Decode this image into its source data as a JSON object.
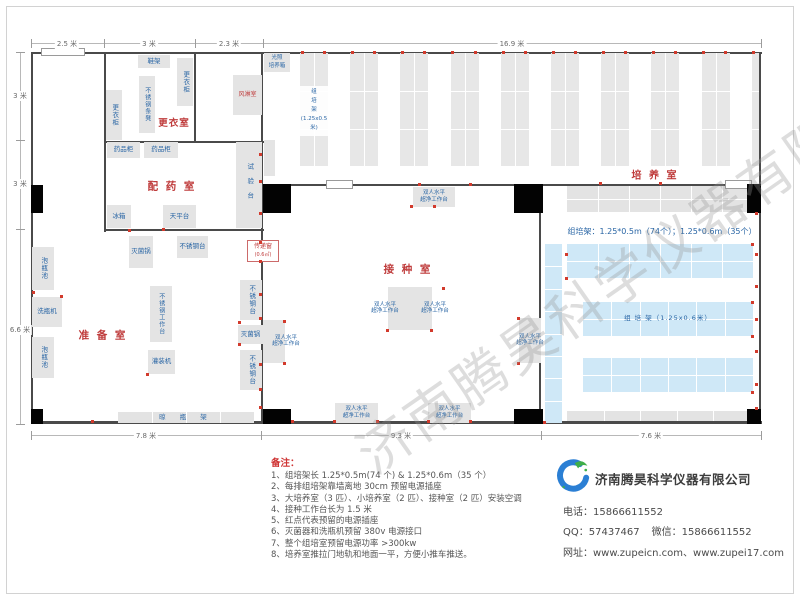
{
  "watermark": "济南腾昊科学仪器有限公司",
  "notes": {
    "title": "备注：",
    "items": [
      "1、组培架长 1.25*0.5m(74 个) & 1.25*0.6m（35 个）",
      "2、每排组培架靠墙离地 30cm 预留电源插座",
      "3、大培养室（3 匹）、小培养室（2 匹）、接种室（2 匹）安装空调",
      "4、接种工作台长为 1.5 米",
      "5、红点代表预留的电源插座",
      "6、灭菌器和洗瓶机预留 380v 电源接口",
      "7、整个组培室预留电源功率 >300kw",
      "8、培养室推拉门地轨和地面一平，方便小推车推送。"
    ]
  },
  "contact": {
    "logo_text": "TH",
    "company": "济南腾昊科学仪器有限公司",
    "phone_label": "电话：",
    "phone": "15866611552",
    "qq_label": "QQ：",
    "qq": "57437467",
    "wechat_label": "微信：",
    "wechat": "15866611552",
    "web_label": "网址：",
    "websites": "www.zupeicn.com、www.zupei17.com"
  },
  "plan": {
    "walls": [
      [
        31,
        52,
        731,
        2
      ],
      [
        31,
        421,
        731,
        3
      ],
      [
        31,
        52,
        2,
        372
      ],
      [
        759,
        52,
        2,
        372
      ],
      [
        104,
        52,
        2,
        180
      ],
      [
        104,
        141,
        160,
        2
      ],
      [
        194,
        52,
        2,
        91
      ],
      [
        104,
        229,
        160,
        2
      ],
      [
        261,
        52,
        2,
        371
      ],
      [
        261,
        184,
        66,
        2
      ],
      [
        352,
        184,
        165,
        2
      ],
      [
        543,
        184,
        183,
        2
      ],
      [
        751,
        184,
        10,
        2
      ],
      [
        539,
        186,
        2,
        236
      ]
    ],
    "pillars": [
      [
        31,
        185,
        12,
        28
      ],
      [
        263,
        184,
        28,
        29
      ],
      [
        514,
        184,
        29,
        29
      ],
      [
        747,
        184,
        14,
        29
      ],
      [
        31,
        409,
        12,
        15
      ],
      [
        263,
        409,
        28,
        15
      ],
      [
        514,
        409,
        29,
        15
      ],
      [
        747,
        409,
        14,
        15
      ]
    ],
    "doors": [
      [
        41,
        48,
        44,
        8
      ],
      [
        326,
        180,
        27,
        9
      ],
      [
        725,
        180,
        27,
        9
      ]
    ],
    "rooms": [
      {
        "name": "changing-room-label",
        "label": "更衣室",
        "cx": 174,
        "cy": 122,
        "fs": 9.5,
        "ls": 1
      },
      {
        "name": "dispensing-room-label",
        "label": "配 药 室",
        "cx": 172,
        "cy": 186,
        "fs": 10.5,
        "ls": 2
      },
      {
        "name": "prep-room-label",
        "label": "准 备 室",
        "cx": 103,
        "cy": 335,
        "fs": 10.5,
        "ls": 2
      },
      {
        "name": "inoculation-room-label",
        "label": "接 种 室",
        "cx": 408,
        "cy": 269,
        "fs": 10.5,
        "ls": 2
      },
      {
        "name": "culture-room-label",
        "label": "培 养 室",
        "cx": 655,
        "cy": 174,
        "fs": 10,
        "ls": 2
      }
    ],
    "equipment": [
      {
        "name": "shoe-rack",
        "label": "鞋架",
        "x": 138,
        "y": 55,
        "w": 32,
        "h": 13,
        "dir": "h"
      },
      {
        "name": "wardrobe-cabinet-1",
        "label": "更衣柜",
        "x": 177,
        "y": 58,
        "w": 16,
        "h": 48,
        "dir": "v"
      },
      {
        "name": "stainless-bench",
        "label": "不锈钢条凳",
        "x": 139,
        "y": 76,
        "w": 16,
        "h": 57,
        "dir": "v",
        "fs": 6
      },
      {
        "name": "wardrobe-cabinet-2",
        "label": "更衣柜",
        "x": 106,
        "y": 90,
        "w": 16,
        "h": 50,
        "dir": "v"
      },
      {
        "name": "air-shower",
        "label": "风淋室",
        "x": 233,
        "y": 75,
        "w": 29,
        "h": 40,
        "dir": "h",
        "red": true,
        "fs": 6
      },
      {
        "name": "light-incubator",
        "label": "光照\n培养箱",
        "x": 264,
        "y": 53,
        "w": 26,
        "h": 19,
        "dir": "h",
        "fs": 5.5
      },
      {
        "name": "side-cabinet",
        "label": "",
        "x": 264,
        "y": 140,
        "w": 11,
        "h": 36,
        "dir": "h"
      },
      {
        "name": "medicine-cabinet-1",
        "label": "药品柜",
        "x": 107,
        "y": 142,
        "w": 33,
        "h": 16,
        "dir": "h"
      },
      {
        "name": "medicine-cabinet-2",
        "label": "药品柜",
        "x": 144,
        "y": 142,
        "w": 34,
        "h": 16,
        "dir": "h"
      },
      {
        "name": "test-bench",
        "label": "试验台",
        "x": 236,
        "y": 142,
        "w": 26,
        "h": 86,
        "dir": "v",
        "ls": 8
      },
      {
        "name": "fridge",
        "label": "冰箱",
        "x": 107,
        "y": 205,
        "w": 24,
        "h": 23,
        "dir": "h"
      },
      {
        "name": "balance-table",
        "label": "天平台",
        "x": 163,
        "y": 205,
        "w": 33,
        "h": 23,
        "dir": "h"
      },
      {
        "name": "sterilizer-pot-1",
        "label": "灭菌锅",
        "x": 129,
        "y": 236,
        "w": 24,
        "h": 32,
        "dir": "h"
      },
      {
        "name": "stainless-table-1",
        "label": "不锈钢台",
        "x": 177,
        "y": 236,
        "w": 31,
        "h": 22,
        "dir": "h"
      },
      {
        "name": "bottle-soak-pool-1",
        "label": "泡瓶池",
        "x": 32,
        "y": 247,
        "w": 22,
        "h": 43,
        "dir": "v"
      },
      {
        "name": "bottle-washer",
        "label": "洗瓶机",
        "x": 32,
        "y": 297,
        "w": 30,
        "h": 30,
        "dir": "h"
      },
      {
        "name": "bottle-soak-pool-2",
        "label": "泡瓶池",
        "x": 32,
        "y": 337,
        "w": 22,
        "h": 41,
        "dir": "v"
      },
      {
        "name": "stainless-worktable",
        "label": "不锈钢工作台",
        "x": 150,
        "y": 286,
        "w": 22,
        "h": 56,
        "dir": "v",
        "fs": 6
      },
      {
        "name": "filling-machine",
        "label": "灌装机",
        "x": 148,
        "y": 350,
        "w": 27,
        "h": 24,
        "dir": "h"
      },
      {
        "name": "stainless-table-2",
        "label": "不锈钢台",
        "x": 240,
        "y": 280,
        "w": 22,
        "h": 40,
        "dir": "v"
      },
      {
        "name": "sterilizer-pot-2",
        "label": "灭菌锅",
        "x": 238,
        "y": 325,
        "w": 25,
        "h": 19,
        "dir": "h"
      },
      {
        "name": "stainless-table-3",
        "label": "不锈钢台",
        "x": 240,
        "y": 350,
        "w": 22,
        "h": 40,
        "dir": "v"
      }
    ],
    "bench_label": "双人水平\n超净工作台",
    "benches": [
      {
        "name": "clean-bench-1",
        "x": 413,
        "y": 187,
        "w": 42,
        "h": 20
      },
      {
        "name": "clean-bench-2",
        "x": 388,
        "y": 287,
        "w": 22,
        "h": 43,
        "tdx": -14
      },
      {
        "name": "clean-bench-3",
        "x": 410,
        "y": 287,
        "w": 22,
        "h": 43,
        "tdx": 14
      },
      {
        "name": "clean-bench-4",
        "x": 263,
        "y": 320,
        "w": 22,
        "h": 43,
        "tdx": 12
      },
      {
        "name": "clean-bench-5",
        "x": 519,
        "y": 318,
        "w": 22,
        "h": 45
      },
      {
        "name": "clean-bench-6",
        "x": 335,
        "y": 403,
        "w": 43,
        "h": 20
      },
      {
        "name": "clean-bench-7",
        "x": 428,
        "y": 403,
        "w": 43,
        "h": 20
      }
    ],
    "rack_columns": {
      "count": 10,
      "x0": 300,
      "step": 50.2,
      "y": 53,
      "w": 28,
      "h": 113,
      "clip": 759,
      "label_lines": "组\n培\n架\n(1.25x0.5米)"
    },
    "grids": [
      {
        "name": "wall-rack-gray",
        "x": 567,
        "y": 186,
        "w": 186,
        "h": 26,
        "rows": 2,
        "cols": 6,
        "color": "#e3e3e3"
      },
      {
        "name": "bottom-rack-gray",
        "x": 567,
        "y": 411,
        "w": 183,
        "h": 10,
        "rows": 1,
        "cols": 5,
        "color": "#e3e3e3"
      },
      {
        "name": "bottle-drying-rack",
        "x": 118,
        "y": 412,
        "w": 136,
        "h": 11,
        "rows": 1,
        "cols": 4,
        "color": "#e3e3e3",
        "label": "晾 瓶 架",
        "lc": "#2a66a5",
        "fs": 6.5,
        "ls": 6
      },
      {
        "name": "tissue-rack-strip",
        "x": 545,
        "y": 244,
        "w": 17,
        "h": 179,
        "rows": 8,
        "cols": 1,
        "color": "#cfe8f7"
      },
      {
        "name": "tissue-rack-blue-1",
        "x": 567,
        "y": 244,
        "w": 186,
        "h": 34,
        "rows": 2,
        "cols": 6,
        "color": "#cfe8f7"
      },
      {
        "name": "tissue-rack-blue-2",
        "x": 583,
        "y": 302,
        "w": 170,
        "h": 34,
        "rows": 2,
        "cols": 6,
        "color": "#cfe8f7",
        "label": "组  培  架（1.25x0.6米）",
        "lc": "#2a66a5",
        "fs": 6.5,
        "ls": 1
      },
      {
        "name": "tissue-rack-blue-3",
        "x": 583,
        "y": 358,
        "w": 170,
        "h": 34,
        "rows": 2,
        "cols": 6,
        "color": "#cfe8f7"
      }
    ],
    "transfer_window": {
      "name": "transfer-window",
      "x": 247,
      "y": 240,
      "w": 32,
      "h": 22,
      "line1": "传递窗",
      "line2": "(0.6㎡)"
    },
    "texts": [
      {
        "name": "rack-spec-note",
        "t": "组培架：1.25*0.5m（74个）；1.25*0.6m（35个）",
        "x": 566,
        "y": 226,
        "w": 192,
        "fs": 8,
        "color": "#2a66a5",
        "align": "center"
      }
    ],
    "dots": [
      [
        302,
        52
      ],
      [
        324,
        52
      ],
      [
        352,
        52
      ],
      [
        374,
        52
      ],
      [
        402,
        52
      ],
      [
        424,
        52
      ],
      [
        452,
        52
      ],
      [
        475,
        52
      ],
      [
        503,
        52
      ],
      [
        525,
        52
      ],
      [
        553,
        52
      ],
      [
        575,
        52
      ],
      [
        603,
        52
      ],
      [
        625,
        52
      ],
      [
        653,
        52
      ],
      [
        675,
        52
      ],
      [
        703,
        52
      ],
      [
        725,
        52
      ],
      [
        753,
        52
      ],
      [
        260,
        154
      ],
      [
        260,
        181
      ],
      [
        260,
        213
      ],
      [
        260,
        242
      ],
      [
        260,
        261
      ],
      [
        260,
        294
      ],
      [
        260,
        318
      ],
      [
        260,
        364
      ],
      [
        260,
        407
      ],
      [
        129,
        230
      ],
      [
        163,
        229
      ],
      [
        147,
        374
      ],
      [
        61,
        296
      ],
      [
        33,
        292
      ],
      [
        239,
        322
      ],
      [
        239,
        344
      ],
      [
        260,
        389
      ],
      [
        411,
        206
      ],
      [
        434,
        206
      ],
      [
        443,
        288
      ],
      [
        387,
        330
      ],
      [
        431,
        330
      ],
      [
        284,
        321
      ],
      [
        284,
        363
      ],
      [
        518,
        363
      ],
      [
        518,
        318
      ],
      [
        334,
        421
      ],
      [
        377,
        421
      ],
      [
        428,
        421
      ],
      [
        470,
        421
      ],
      [
        419,
        184
      ],
      [
        470,
        184
      ],
      [
        600,
        183
      ],
      [
        660,
        183
      ],
      [
        756,
        213
      ],
      [
        756,
        254
      ],
      [
        756,
        286
      ],
      [
        756,
        319
      ],
      [
        756,
        351
      ],
      [
        756,
        384
      ],
      [
        756,
        408
      ],
      [
        544,
        422
      ],
      [
        566,
        254
      ],
      [
        566,
        278
      ],
      [
        752,
        244
      ],
      [
        752,
        302
      ],
      [
        752,
        336
      ],
      [
        752,
        392
      ],
      [
        92,
        421
      ],
      [
        292,
        421
      ]
    ],
    "dims": {
      "top": {
        "axis": 43,
        "from": 31,
        "to": 761,
        "ticks": [
          31,
          104,
          195,
          263,
          761
        ],
        "labels": [
          {
            "t": "2.5 米",
            "at": 67
          },
          {
            "t": "3 米",
            "at": 149
          },
          {
            "t": "2.3 米",
            "at": 229
          },
          {
            "t": "16.9 米",
            "at": 512
          }
        ]
      },
      "bottom": {
        "axis": 435,
        "from": 31,
        "to": 761,
        "ticks": [
          31,
          261,
          541,
          761
        ],
        "labels": [
          {
            "t": "7.8 米",
            "at": 146
          },
          {
            "t": "9.3 米",
            "at": 401
          },
          {
            "t": "7.6 米",
            "at": 651
          }
        ]
      },
      "left": {
        "axis": 20,
        "from": 52,
        "to": 424,
        "ticks": [
          52,
          140,
          229,
          424
        ],
        "labels": [
          {
            "t": "3 米",
            "at": 96
          },
          {
            "t": "3 米",
            "at": 184
          },
          {
            "t": "6.6 米",
            "at": 330
          }
        ]
      }
    }
  }
}
